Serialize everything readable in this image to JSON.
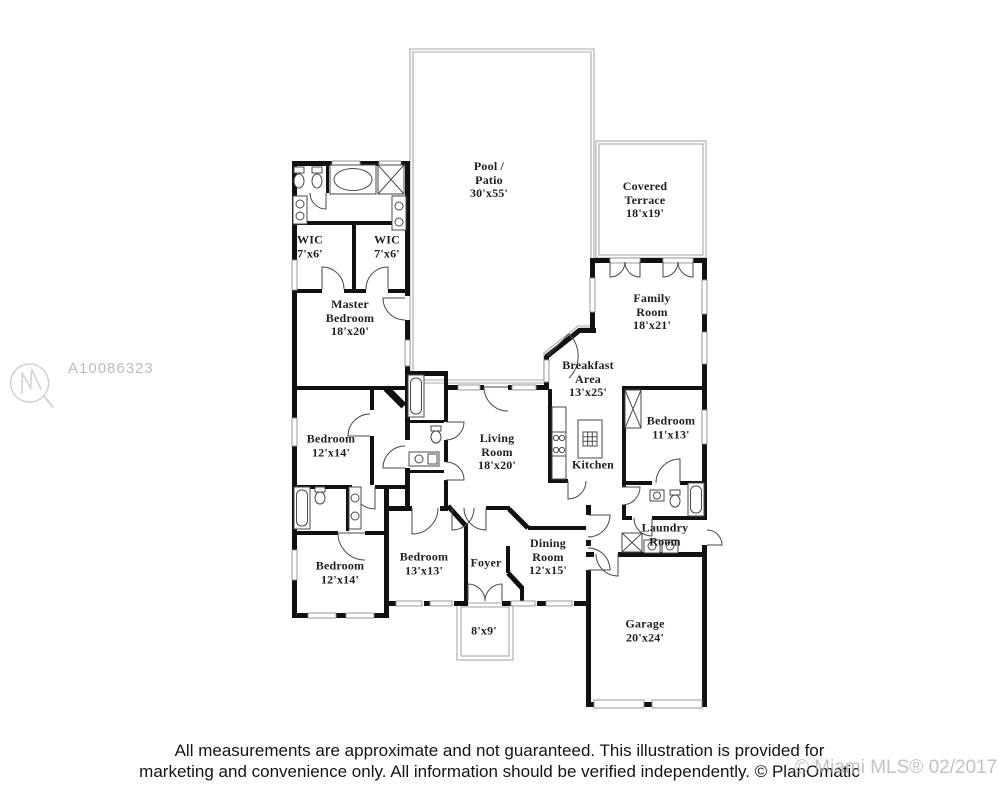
{
  "watermark": {
    "listing_id": "A10086323"
  },
  "footer": {
    "line1": "All measurements are approximate and not guaranteed. This illustration is provided for",
    "line2": "marketing and convenience only. All information should be verified independently. © PlanOmatic",
    "mls_overlay": "© Miami MLS® 02/2017"
  },
  "colors": {
    "wall": "#111111",
    "outdoor_outline": "#a8a8a8",
    "label_text": "#1f1f1f",
    "watermark_gray": "#bdbdbd",
    "footer_text": "#141414",
    "mls_gray": "#b3b3b3"
  },
  "rooms": [
    {
      "id": "pool-patio",
      "lines": [
        "Pool /",
        "Patio",
        "30'x55'"
      ],
      "x": 489,
      "y": 180
    },
    {
      "id": "covered-terrace",
      "lines": [
        "Covered",
        "Terrace",
        "18'x19'"
      ],
      "x": 645,
      "y": 200
    },
    {
      "id": "wic-left",
      "lines": [
        "WIC",
        "7'x6'"
      ],
      "x": 310,
      "y": 247
    },
    {
      "id": "wic-right",
      "lines": [
        "WIC",
        "7'x6'"
      ],
      "x": 387,
      "y": 247
    },
    {
      "id": "master-bedroom",
      "lines": [
        "Master",
        "Bedroom",
        "18'x20'"
      ],
      "x": 350,
      "y": 318
    },
    {
      "id": "family-room",
      "lines": [
        "Family",
        "Room",
        "18'x21'"
      ],
      "x": 652,
      "y": 312
    },
    {
      "id": "breakfast-area",
      "lines": [
        "Breakfast",
        "Area",
        "13'x25'"
      ],
      "x": 588,
      "y": 379
    },
    {
      "id": "bedroom-upper-left",
      "lines": [
        "Bedroom",
        "12'x14'"
      ],
      "x": 331,
      "y": 446
    },
    {
      "id": "bedroom-right",
      "lines": [
        "Bedroom",
        "11'x13'"
      ],
      "x": 671,
      "y": 428
    },
    {
      "id": "living-room",
      "lines": [
        "Living",
        "Room",
        "18'x20'"
      ],
      "x": 497,
      "y": 452
    },
    {
      "id": "kitchen",
      "lines": [
        "Kitchen"
      ],
      "x": 593,
      "y": 465
    },
    {
      "id": "bedroom-lower-left",
      "lines": [
        "Bedroom",
        "12'x14'"
      ],
      "x": 340,
      "y": 573
    },
    {
      "id": "bedroom-center",
      "lines": [
        "Bedroom",
        "13'x13'"
      ],
      "x": 424,
      "y": 564
    },
    {
      "id": "foyer",
      "lines": [
        "Foyer"
      ],
      "x": 486,
      "y": 563
    },
    {
      "id": "dining-room",
      "lines": [
        "Dining",
        "Room",
        "12'x15'"
      ],
      "x": 548,
      "y": 557
    },
    {
      "id": "laundry-room",
      "lines": [
        "Laundry",
        "Room"
      ],
      "x": 665,
      "y": 535
    },
    {
      "id": "entry-porch",
      "lines": [
        "8'x9'"
      ],
      "x": 484,
      "y": 631
    },
    {
      "id": "garage",
      "lines": [
        "Garage",
        "20'x24'"
      ],
      "x": 645,
      "y": 631
    }
  ]
}
